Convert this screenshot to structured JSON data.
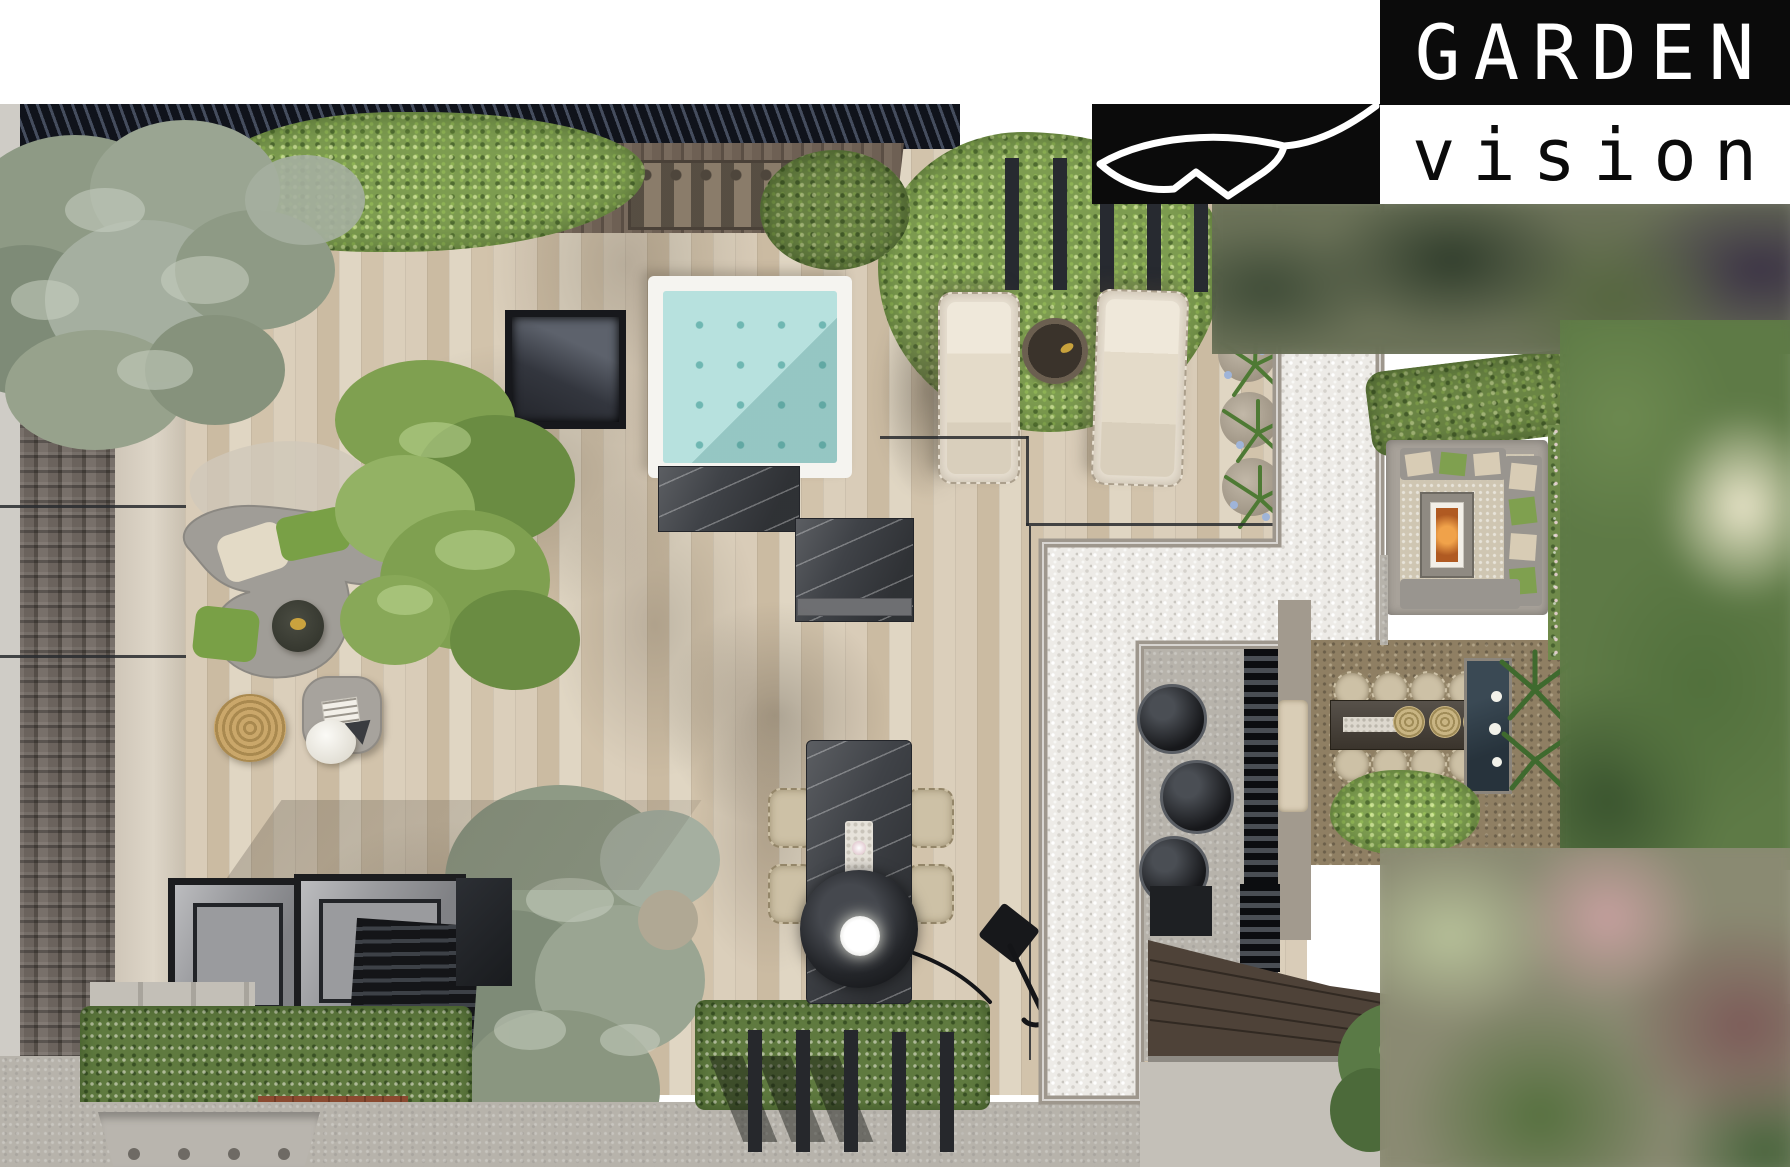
{
  "logo": {
    "title": "GARDEN",
    "subtitle": "vision"
  },
  "icons": {
    "logo_leaf": "leaf-outline"
  },
  "palette": {
    "logo_bg": "#0b0b0b",
    "logo_fg": "#ffffff",
    "deck_a": "#d9ccb8",
    "deck_b": "#cbbba2",
    "deck_c": "#e0d6c3",
    "water": "#b7e1de",
    "water_jet": "#6fb7b2",
    "pool_frame": "#f5f4f0",
    "gravel": "#edebe7",
    "gravel_curb": "#9e978d",
    "hedge": "#7d9c50",
    "olive": "#97a28c",
    "roof": "#645c55",
    "canopy_slat": "#141820",
    "wood_wall": "#6e6054",
    "marble": "#3f4247",
    "concrete": "#b7b3ab",
    "black": "#1d1f22",
    "wicker": "#cdc1a6",
    "copper": "#c87a1e",
    "fire": "#e07a2e",
    "dark_water": "#2b3740",
    "dirt": "#8f7f63",
    "grass_band": "#5f7a3f"
  }
}
